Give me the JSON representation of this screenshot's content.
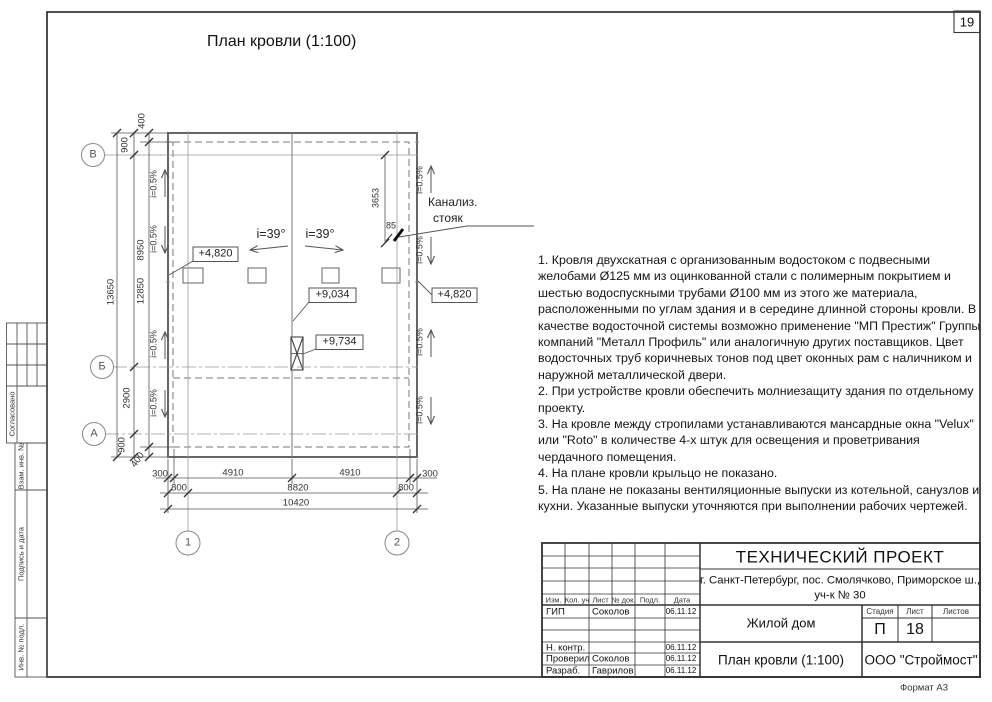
{
  "sheet": {
    "number": "19",
    "format": "Формат А3"
  },
  "title": "План кровли (1:100)",
  "plan": {
    "axes_rows": [
      "В",
      "Б",
      "А"
    ],
    "axes_cols": [
      "1",
      "2"
    ],
    "roof_slope_left": "i=39°",
    "roof_slope_right": "i=39°",
    "eaves_slope": "i=0.5%",
    "sewer_riser": {
      "line1": "Канализ.",
      "line2": "стояк"
    },
    "elevations": {
      "eaves_left": "+4,820",
      "eaves_right": "+4,820",
      "ridge": "+9,034",
      "chimney": "+9,734"
    },
    "dims": {
      "v_total": "13650",
      "v_wall": "12850",
      "v_overhang_top": "400",
      "v_edge_to_B": "900",
      "v_B_to_B2": "8950",
      "v_B2_to_A": "2900",
      "v_A_to_edge": "900",
      "v_overhang_bottom": "400",
      "riser_v": "3653",
      "riser_offset": "85",
      "b1_left": "300",
      "b1_mid_left": "4910",
      "b1_mid_right": "4910",
      "b1_right": "300",
      "b2_left": "800",
      "b2_mid": "8820",
      "b2_right": "800",
      "b3_total": "10420"
    }
  },
  "notes": [
    "1. Кровля двухскатная с организованным водостоком с подвесными желобами Ø125 мм из оцинкованной стали с полимерным покрытием и шестью водоспускными трубами Ø100 мм из этого же материала, расположенными по углам здания и в середине длинной стороны кровли. В качестве водосточной системы возможно применение \"МП Престиж\" Группы компаний \"Металл Профиль\" или аналогичную других поставщиков. Цвет водосточных труб коричневых тонов под цвет оконных рам с наличником и наружной металлической двери.",
    "2. При устройстве кровли обеспечить молниезащиту здания по отдельному проекту.",
    "3. На кровле между стропилами устанавливаются мансардные окна \"Velux\" или \"Roto\" в количестве 4-х штук для освещения и проветривания чердачного помещения.",
    "4. На плане кровли крыльцо не показано.",
    "5. На плане не показаны вентиляционные выпуски из котельной, санузлов и кухни. Указанные выпуски уточняются при выполнении рабочих чертежей."
  ],
  "stamp": {
    "project_type": "ТЕХНИЧЕСКИЙ ПРОЕКТ",
    "address_line1": "г. Санкт-Петербург, пос. Смолячково, Приморское ш.,",
    "address_line2": "уч-к № 30",
    "object": "Жилой дом",
    "sheet_title": "План кровли (1:100)",
    "company": "ООО \"Строймост\"",
    "stage_label": "Стадия",
    "sheet_label": "Лист",
    "sheets_label": "Листов",
    "stage": "П",
    "sheet_no": "18",
    "cols": {
      "izm": "Изм.",
      "kol": "Кол. уч",
      "list": "Лист",
      "doc": "№ док.",
      "podp": "Подл.",
      "data": "Дата"
    },
    "rows": [
      {
        "role": "ГИП",
        "name": "Соколов",
        "date": "06.11.12"
      },
      {
        "role": "",
        "name": "",
        "date": ""
      },
      {
        "role": "",
        "name": "",
        "date": ""
      },
      {
        "role": "Н. контр.",
        "name": "",
        "date": "06.11.12"
      },
      {
        "role": "Проверил",
        "name": "Соколов",
        "date": "06.11.12"
      },
      {
        "role": "Разраб.",
        "name": "Гаврилов",
        "date": "06.11.12"
      }
    ]
  },
  "margin_labels": [
    "Согласовано",
    "Взам. инв. №",
    "Подпись и дата",
    "Инв. № подл."
  ]
}
